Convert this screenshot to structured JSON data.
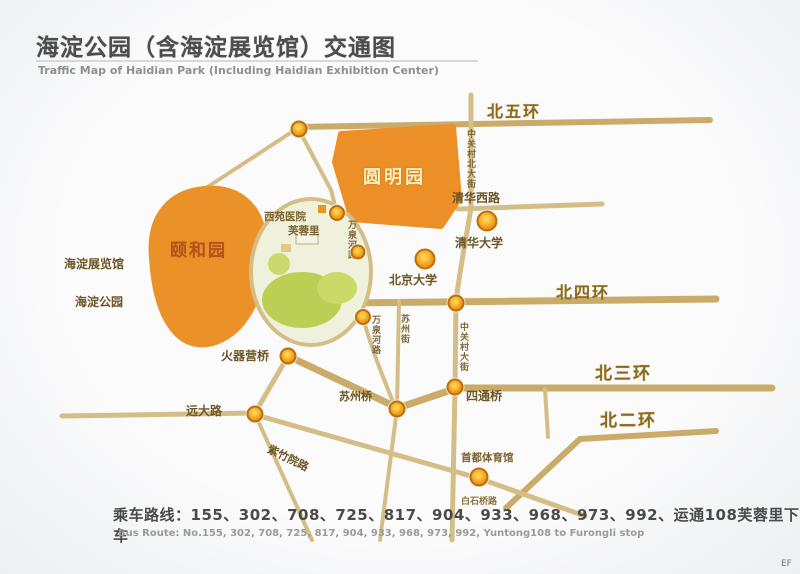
{
  "header": {
    "title_cn": "海淀公园（含海淀展览馆）交通图",
    "title_en": "Traffic Map of Haidian Park (Including Haidian Exhibition Center)"
  },
  "labels": [
    {
      "id": "bei-wu-huan",
      "text": "北五环"
    },
    {
      "id": "qinghua-xi-lu",
      "text": "清华西路"
    },
    {
      "id": "qinghua-daxue",
      "text": "清华大学"
    },
    {
      "id": "beijing-daxue",
      "text": "北京大学"
    },
    {
      "id": "bei-si-huan",
      "text": "北四环"
    },
    {
      "id": "bei-san-huan",
      "text": "北三环"
    },
    {
      "id": "bei-er-huan",
      "text": "北二环"
    },
    {
      "id": "haidian-zhanlanguan",
      "text": "海淀展览馆"
    },
    {
      "id": "haidian-gongyuan",
      "text": "海淀公园"
    },
    {
      "id": "xiyuan-yiyuan",
      "text": "西苑医院"
    },
    {
      "id": "furongli",
      "text": "芙蓉里"
    },
    {
      "id": "huoqiying-qiao",
      "text": "火器营桥"
    },
    {
      "id": "yuanda-lu",
      "text": "远大路"
    },
    {
      "id": "suzhou-qiao",
      "text": "苏州桥"
    },
    {
      "id": "sitong-qiao",
      "text": "四通桥"
    },
    {
      "id": "zizhuyuan-lu",
      "text": "紫竹院路"
    },
    {
      "id": "shoudu-tiyuguan",
      "text": "首都体育馆"
    },
    {
      "id": "baishiqiao-lu",
      "text": "白石桥路"
    },
    {
      "id": "wanquanhe-lu-n",
      "text": "万泉河路"
    },
    {
      "id": "wanquanhe-lu-s",
      "text": "万泉河路"
    },
    {
      "id": "suzhou-jie",
      "text": "苏州街"
    },
    {
      "id": "zhongguancun-dajie",
      "text": "中关村大街"
    },
    {
      "id": "zhongguancun-bei-dajie",
      "text": "中关村北大街"
    },
    {
      "id": "yuanmingyuan",
      "text": "圆明园"
    },
    {
      "id": "yiheyuan",
      "text": "颐和园"
    }
  ],
  "footer": {
    "bus_route_cn": "乘车路线：155、302、708、725、817、904、933、968、973、992、运通108芙蓉里下车",
    "bus_route_en": "Bus Route: No.155, 302, 708, 725, 817, 904, 933, 968, 973, 992, Yuntong108 to Furongli stop"
  },
  "corner_mark": "EF",
  "icons": {
    "poi_marker": "orange-circle-dot"
  },
  "colors": {
    "area_orange": "#ec8f26",
    "road_tan": "#cbab69",
    "road_tan_light": "#d4bd87",
    "dot_orange": "#ef9416",
    "park_green": "#bccf55",
    "title_gray": "#4d4d4d"
  }
}
